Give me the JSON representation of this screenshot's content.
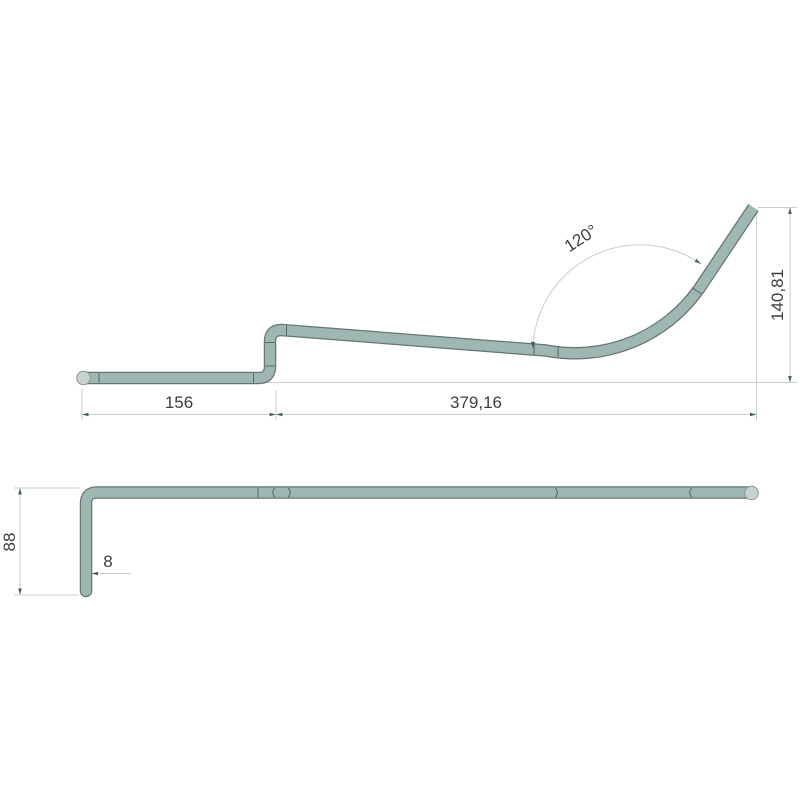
{
  "document": {
    "type": "technical-drawing",
    "subject": "bent-tube-part-two-views"
  },
  "colors": {
    "tube-fill": "#9eb7b3",
    "tube-outline": "#67766f",
    "cap-fill": "#c8d2cf",
    "cap-outline": "#8a9894",
    "dim-line": "#c6d0cd",
    "arrow": "#4a6157",
    "tick": "#4f5f58",
    "text": "#3d3d3d",
    "background": "#ffffff"
  },
  "views": {
    "front": {
      "name": "front-view",
      "dimensions": {
        "bend_angle": "120°",
        "end_height": "140,81",
        "left_length": "156",
        "right_length": "379,16"
      }
    },
    "top": {
      "name": "top-view",
      "dimensions": {
        "leg_length": "88",
        "tube_diameter": "8"
      }
    }
  }
}
